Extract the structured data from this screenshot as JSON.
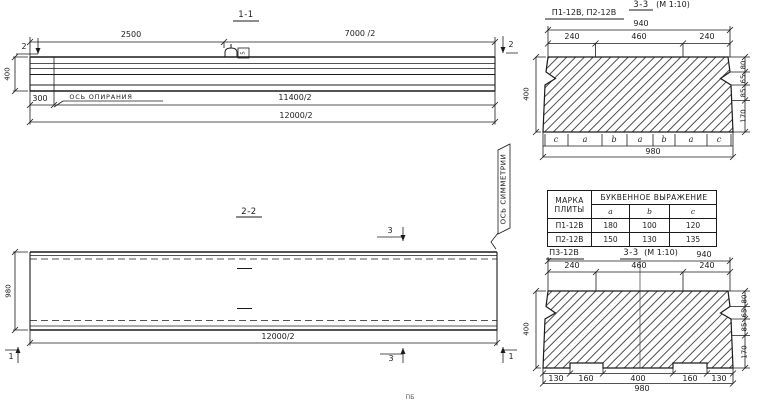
{
  "ink": "#1b1b1b",
  "v11": {
    "title": "1-1",
    "dim_2500": "2500",
    "dim_7000": "7000 /2",
    "dim_400": "400",
    "dim_300": "300",
    "bearing_axis": "ОСЬ ОПИРАНИЯ",
    "dim_11400": "11400/2",
    "dim_12000": "12000/2",
    "cut_left": "2",
    "cut_right": "2",
    "loop_tag": "5"
  },
  "sym": {
    "label": "ОСЬ СИММЕТРИИ"
  },
  "v22": {
    "title": "2-2",
    "dim_980": "980",
    "dim_12000": "12000/2",
    "cut3_top": "3",
    "cut3_bottom": "3",
    "cut1_left": "1",
    "cut1_right": "1"
  },
  "s12": {
    "label": "П1-12В, П2-12В",
    "title": "3-3",
    "scale": "(М 1:10)",
    "dim_940": "940",
    "seg_240a": "240",
    "seg_460": "460",
    "seg_240b": "240",
    "dim_400": "400",
    "r80": "80",
    "r65": "65",
    "r85": "85",
    "r170": "170",
    "letters": [
      "c",
      "a",
      "b",
      "a",
      "b",
      "a",
      "c"
    ],
    "dim_980": "980"
  },
  "tbl": {
    "h_mark_1": "МАРКА",
    "h_mark_2": "ПЛИТЫ",
    "h_expr": "БУКВЕННОЕ ВЫРАЖЕНИЕ",
    "cols": [
      "a",
      "b",
      "c"
    ],
    "rows": [
      {
        "mark": "П1-12В",
        "a": "180",
        "b": "100",
        "c": "120"
      },
      {
        "mark": "П2-12В",
        "a": "150",
        "b": "130",
        "c": "135"
      }
    ]
  },
  "s3": {
    "label": "П3-12В",
    "title": "3-3",
    "scale": "(М 1:10)",
    "dim_940": "940",
    "seg_240a": "240",
    "seg_460": "460",
    "seg_240b": "240",
    "dim_400": "400",
    "r80": "80",
    "r65": "65",
    "r85": "85",
    "r170": "170",
    "b130a": "130",
    "b160a": "160",
    "b400": "400",
    "b160b": "160",
    "b130b": "130",
    "dim_980": "980"
  },
  "cropped_text": "ПБ"
}
